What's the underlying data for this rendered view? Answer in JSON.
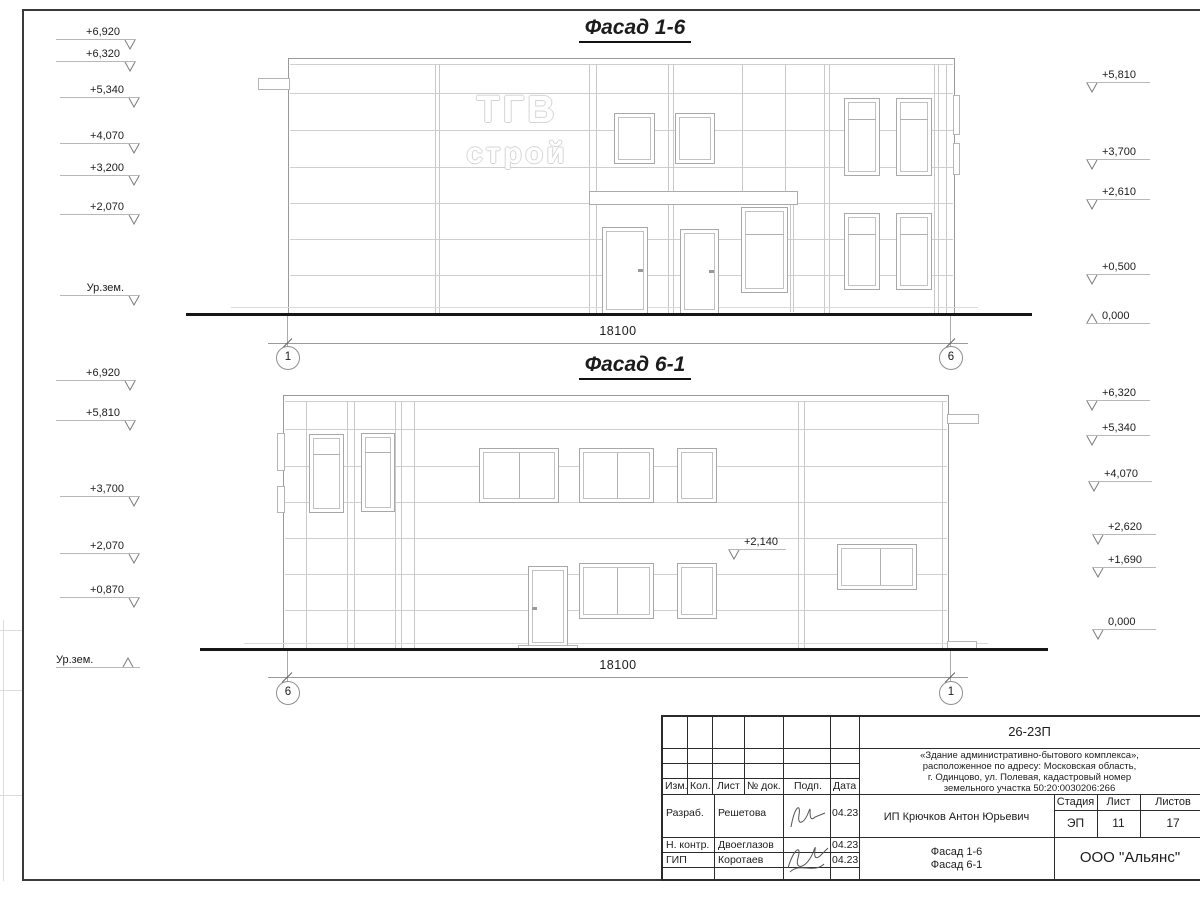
{
  "sheet_titles": {
    "facade16": "Фасад 1-6",
    "facade61": "Фасад 6-1"
  },
  "logo": {
    "line1": "ТГВ",
    "line2": "строй"
  },
  "facade16": {
    "title": "Фасад 1-6",
    "dimension": "18100",
    "axis_left": "1",
    "axis_right": "6",
    "left_marks": [
      {
        "label": "+6,920",
        "x": 56,
        "y": 26,
        "dir": "dr"
      },
      {
        "label": "+6,320",
        "x": 56,
        "y": 48,
        "dir": "dr"
      },
      {
        "label": "+5,340",
        "x": 60,
        "y": 84,
        "dir": "dr"
      },
      {
        "label": "+4,070",
        "x": 60,
        "y": 130,
        "dir": "dr"
      },
      {
        "label": "+3,200",
        "x": 60,
        "y": 162,
        "dir": "dr"
      },
      {
        "label": "+2,070",
        "x": 60,
        "y": 201,
        "dir": "dr"
      },
      {
        "label": "Ур.зем.",
        "x": 60,
        "y": 282,
        "dir": "dr"
      }
    ],
    "right_marks": [
      {
        "label": "+5,810",
        "x": 1086,
        "y": 69,
        "dir": "dl"
      },
      {
        "label": "+3,700",
        "x": 1086,
        "y": 146,
        "dir": "dl"
      },
      {
        "label": "+2,610",
        "x": 1086,
        "y": 186,
        "dir": "dl"
      },
      {
        "label": "+0,500",
        "x": 1086,
        "y": 261,
        "dir": "dl"
      },
      {
        "label": "0,000",
        "x": 1086,
        "y": 310,
        "dir": "ul"
      }
    ]
  },
  "facade61": {
    "title": "Фасад 6-1",
    "dimension": "18100",
    "axis_left": "6",
    "axis_right": "1",
    "left_marks": [
      {
        "label": "+6,920",
        "x": 56,
        "y": 367,
        "dir": "dr"
      },
      {
        "label": "+5,810",
        "x": 56,
        "y": 407,
        "dir": "dr"
      },
      {
        "label": "+3,700",
        "x": 60,
        "y": 483,
        "dir": "dr"
      },
      {
        "label": "+2,070",
        "x": 60,
        "y": 540,
        "dir": "dr"
      },
      {
        "label": "+0,870",
        "x": 60,
        "y": 584,
        "dir": "dr"
      },
      {
        "label": "Ур.зем.",
        "x": 56,
        "y": 654,
        "dir": "ur",
        "w": 84
      }
    ],
    "right_marks": [
      {
        "label": "+6,320",
        "x": 1086,
        "y": 387,
        "dir": "dl"
      },
      {
        "label": "+5,340",
        "x": 1086,
        "y": 422,
        "dir": "dl"
      },
      {
        "label": "+4,070",
        "x": 1088,
        "y": 468,
        "dir": "dl"
      },
      {
        "label": "+2,620",
        "x": 1092,
        "y": 521,
        "dir": "dl"
      },
      {
        "label": "+1,690",
        "x": 1092,
        "y": 554,
        "dir": "dl"
      },
      {
        "label": "0,000",
        "x": 1092,
        "y": 616,
        "dir": "dl"
      }
    ],
    "inner_marks": [
      {
        "label": "+2,140",
        "x": 728,
        "y": 536,
        "dir": "dl",
        "w": 58
      }
    ]
  },
  "title_block": {
    "code": "26-23П",
    "desc1": "«Здание административно-бытового комплекса»,",
    "desc2": "расположенное по адресу: Московская область,",
    "desc3": "г. Одинцово, ул. Полевая, кадастровый номер",
    "desc4": "земельного участка 50:20:0030206:266",
    "col_izm": "Изм.",
    "col_kol": "Кол.",
    "col_list": "Лист",
    "col_doc": "№ док.",
    "col_podp": "Подп.",
    "col_data": "Дата",
    "row1_role": "Разраб.",
    "row1_name": "Решетова",
    "row1_date": "04.23",
    "row2_role": "Н. контр.",
    "row2_name": "Двоеглазов",
    "row2_date": "04.23",
    "row3_role": "ГИП",
    "row3_name": "Коротаев",
    "row3_date": "04.23",
    "client": "ИП Крючков Антон Юрьевич",
    "stage_label": "Стадия",
    "sheet_label": "Лист",
    "sheets_label": "Листов",
    "stage": "ЭП",
    "sheet": "11",
    "sheets": "17",
    "sheet_title_line1": "Фасад 1-6",
    "sheet_title_line2": "Фасад 6-1",
    "company": "ООО \"Альянс\""
  }
}
